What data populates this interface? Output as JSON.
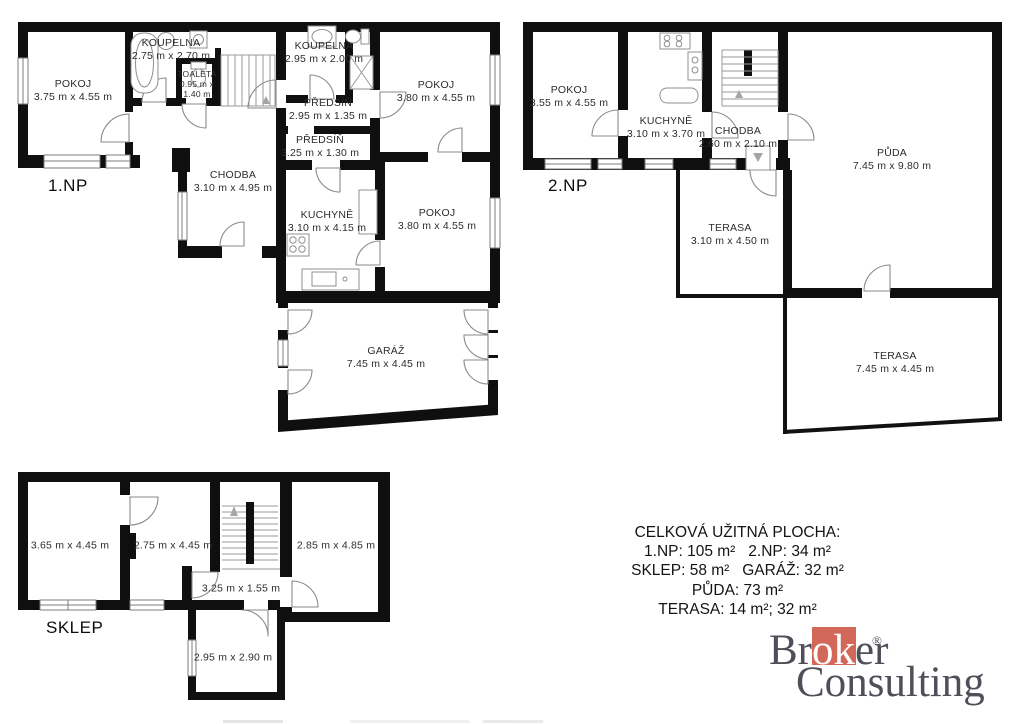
{
  "page": {
    "background": "#ffffff",
    "wall_color": "#0f0f0f",
    "accent_color": "#d2685a"
  },
  "plans": {
    "np1": {
      "floor_label": "1.NP",
      "rooms": [
        {
          "name": "POKOJ",
          "dims": "3.75 m x 4.55 m"
        },
        {
          "name": "KOUPELNA",
          "dims": "2.75 m x 2.70 m"
        },
        {
          "name": "TOALETA",
          "dims": "0.95 m x 1.40 m"
        },
        {
          "name": "KOUPELNA",
          "dims": "2.95 m x 2.00 m"
        },
        {
          "name": "PŘEDSÍŇ",
          "dims": "2.95 m x 1.35 m"
        },
        {
          "name": "POKOJ",
          "dims": "3.80 m x 4.55 m"
        },
        {
          "name": "PŘEDSÍŇ",
          "dims": "3.25 m x 1.30 m"
        },
        {
          "name": "CHODBA",
          "dims": "3.10 m x 4.95 m"
        },
        {
          "name": "KUCHYNĚ",
          "dims": "3.10 m x 4.15 m"
        },
        {
          "name": "POKOJ",
          "dims": "3.80 m x 4.55 m"
        },
        {
          "name": "GARÁŽ",
          "dims": "7.45 m x 4.45 m"
        }
      ]
    },
    "np2": {
      "floor_label": "2.NP",
      "rooms": [
        {
          "name": "POKOJ",
          "dims": "3.55 m x 4.55 m"
        },
        {
          "name": "KUCHYNĚ",
          "dims": "3.10 m x 3.70 m"
        },
        {
          "name": "CHODBA",
          "dims": "2.60 m x 2.10 m"
        },
        {
          "name": "PŮDA",
          "dims": "7.45 m x 9.80 m"
        },
        {
          "name": "TERASA",
          "dims": "3.10 m x 4.50 m"
        },
        {
          "name": "TERASA",
          "dims": "7.45 m x 4.45 m"
        }
      ]
    },
    "sklep": {
      "floor_label": "SKLEP",
      "rooms": [
        {
          "dims": "3.65 m x 4.45 m"
        },
        {
          "dims": "2.75 m x 4.45 m"
        },
        {
          "dims": "2.85 m x 4.85 m"
        },
        {
          "dims": "3.25 m x 1.55 m"
        },
        {
          "dims": "2.95 m x 2.90 m"
        }
      ]
    }
  },
  "summary": {
    "title": "CELKOVÁ UŽITNÁ PLOCHA:",
    "lines": [
      "1.NP: 105 m²   2.NP: 34 m²",
      "SKLEP: 58 m²   GARÁŽ: 32 m²",
      "PŮDA: 73 m²",
      "TERASA: 14 m²; 32 m²"
    ]
  },
  "logo": {
    "word1_part1": "Br",
    "word1_part2": "ok",
    "word1_part3": "er",
    "registered": "®",
    "word2": "Consulting",
    "accent_color": "#d2685a",
    "text_color": "#4f4e59"
  }
}
